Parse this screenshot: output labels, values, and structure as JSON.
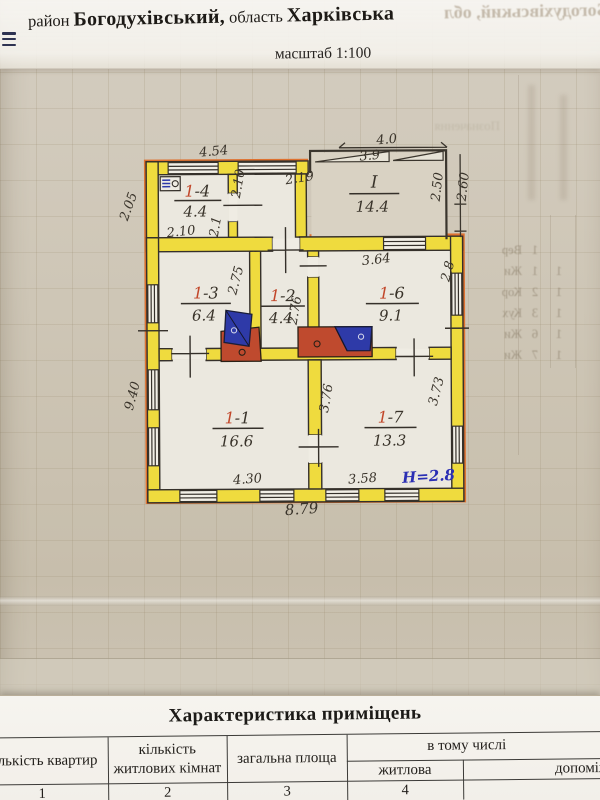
{
  "header": {
    "prefix": "район",
    "district": "Богодухівський,",
    "middle": "область",
    "region": "Харківська",
    "scale": "масштаб 1:100"
  },
  "plan": {
    "rooms": [
      {
        "num": "1",
        "suffix": "-4",
        "area": "4.4"
      },
      {
        "num": "I",
        "suffix": "",
        "area": "14.4"
      },
      {
        "num": "1",
        "suffix": "-3",
        "area": "6.4"
      },
      {
        "num": "1",
        "suffix": "-2",
        "area": "4.4"
      },
      {
        "num": "1",
        "suffix": "-6",
        "area": "9.1"
      },
      {
        "num": "1",
        "suffix": "-1",
        "area": "16.6"
      },
      {
        "num": "1",
        "suffix": "-7",
        "area": "13.3"
      }
    ],
    "dims": {
      "annex_top": "4.54",
      "corridor_wall": "2.19",
      "veranda_top_outer": "4.0",
      "veranda_top_inner": "3.9",
      "veranda_right_inner": "2.50",
      "veranda_right_outer": "2.60",
      "annex_left": "2.05",
      "corridor_width": "2.10",
      "room14_depth": "2.1",
      "room14_width": "2.10",
      "main_left": "9.40",
      "room13_depth": "2.75",
      "room12_depth": "2.76",
      "room16_width": "3.64",
      "room16_depth": "2.8",
      "room11_depth": "3.76",
      "room17_depth": "3.73",
      "room11_width": "4.30",
      "room17_width": "3.58",
      "main_bottom": "8.79",
      "ceiling_height": "Н=2.8"
    }
  },
  "table": {
    "title": "Характеристика приміщень",
    "col1": "кількість квартир",
    "col2a": "кількість",
    "col2b": "житлових кімнат",
    "col3": "загальна площа",
    "col4_group": "в тому числі",
    "col4": "житлова",
    "col5": "допоміжна",
    "numbers": [
      "1",
      "2",
      "3",
      "4"
    ]
  },
  "bleedthrough": {
    "header_ghost": "Богодухівський, обл",
    "note_ghost": "Позначення",
    "rows": [
      {
        "label": "Вер",
        "n1": "1",
        "n2": ""
      },
      {
        "label": "Жи",
        "n1": "1",
        "n2": "1"
      },
      {
        "label": "Кор",
        "n1": "2",
        "n2": "1"
      },
      {
        "label": "Кух",
        "n1": "3",
        "n2": "1"
      },
      {
        "label": "Жи",
        "n1": "6",
        "n2": "1"
      },
      {
        "label": "Жи",
        "n1": "7",
        "n2": "1"
      }
    ]
  },
  "colors": {
    "wall_yellow": "#efdb3e",
    "outline_orange": "#df7230",
    "stove_red": "#bf4a2e",
    "stove_blue": "#2e3aa8",
    "ink_blue": "#2b2fb4",
    "room_number_red": "#c2472a"
  }
}
